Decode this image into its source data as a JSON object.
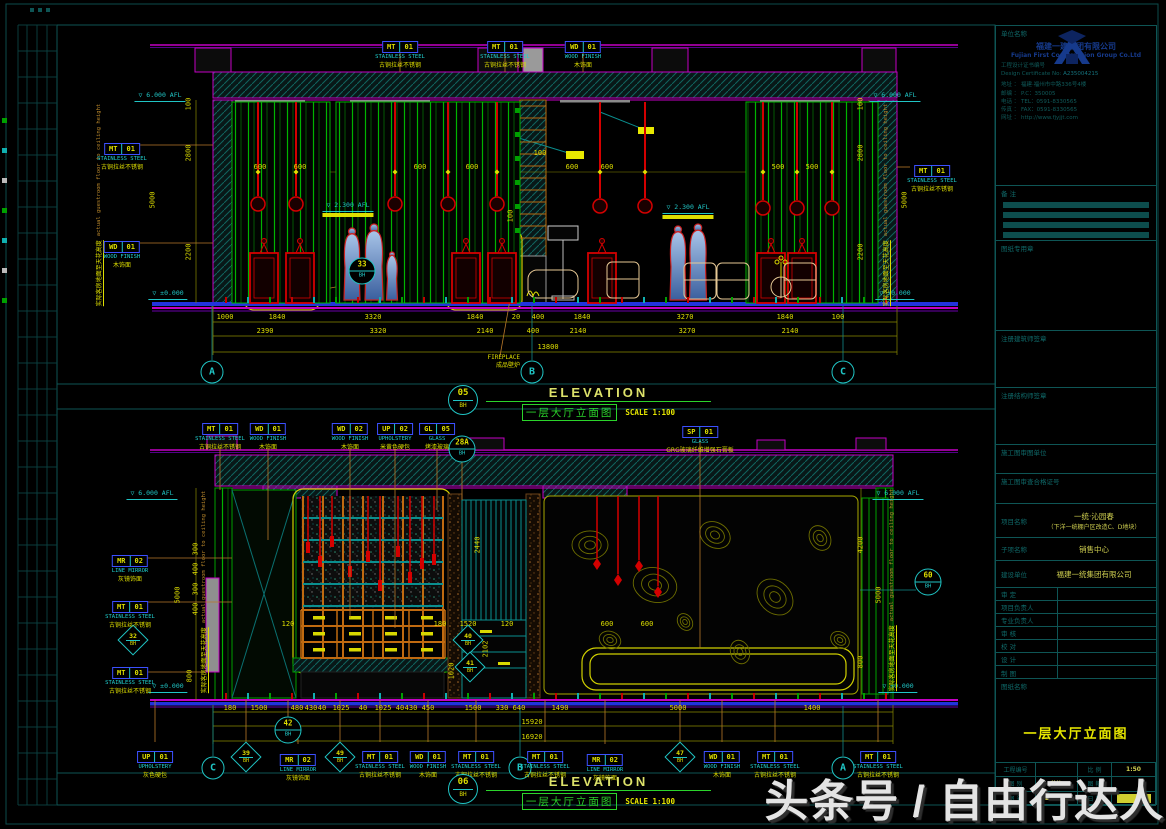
{
  "watermark": "头条号 / 自由行达人",
  "colors": {
    "background": "#000000",
    "frame_teal": "#0e5555",
    "magenta": "#c400c4",
    "green": "#00b400",
    "red": "#d40000",
    "dim_yellow": "#dede00",
    "cyan": "#20c5c5",
    "callout_blue": "#3c50ff",
    "logo_navy": "#163a8c"
  },
  "titles": {
    "upper": {
      "num": "05",
      "sheet": "BH",
      "en": "ELEVATION",
      "cn": "一层大厅立面图",
      "scale": "SCALE 1:100"
    },
    "lower": {
      "num": "06",
      "sheet": "BH",
      "en": "ELEVATION",
      "cn": "一层大厅立面图",
      "scale": "SCALE 1:100"
    }
  },
  "vtext": {
    "cn": "实际客房地面至天花高度",
    "en": "actual guestroom floor to ceiling height"
  },
  "upper": {
    "callouts": [
      {
        "x": 400,
        "y": 34,
        "code": "MT",
        "num": "01",
        "en": "STAINLESS STEEL",
        "cn": "古铜拉丝不锈钢"
      },
      {
        "x": 505,
        "y": 34,
        "code": "MT",
        "num": "01",
        "en": "STAINLESS STEEL",
        "cn": "古铜拉丝不锈钢"
      },
      {
        "x": 583,
        "y": 34,
        "code": "WD",
        "num": "01",
        "en": "WOOD FINISH",
        "cn": "木饰面"
      },
      {
        "x": 122,
        "y": 136,
        "code": "MT",
        "num": "01",
        "en": "STAINLESS STEEL",
        "cn": "古铜拉丝不锈钢"
      },
      {
        "x": 122,
        "y": 234,
        "code": "WD",
        "num": "01",
        "en": "WOOD FINISH",
        "cn": "木饰面"
      },
      {
        "x": 932,
        "y": 158,
        "code": "MT",
        "num": "01",
        "en": "STAINLESS STEEL",
        "cn": "古铜拉丝不锈钢"
      }
    ],
    "dims": [
      {
        "v": "1000",
        "x": 225,
        "y": 314
      },
      {
        "v": "1840",
        "x": 277,
        "y": 314
      },
      {
        "v": "3320",
        "x": 373,
        "y": 314
      },
      {
        "v": "1840",
        "x": 475,
        "y": 314
      },
      {
        "v": "20",
        "x": 516,
        "y": 314
      },
      {
        "v": "400",
        "x": 538,
        "y": 314
      },
      {
        "v": "1840",
        "x": 582,
        "y": 314
      },
      {
        "v": "3270",
        "x": 685,
        "y": 314
      },
      {
        "v": "1840",
        "x": 785,
        "y": 314
      },
      {
        "v": "100",
        "x": 838,
        "y": 314
      },
      {
        "v": "2390",
        "x": 265,
        "y": 328
      },
      {
        "v": "3320",
        "x": 378,
        "y": 328
      },
      {
        "v": "2140",
        "x": 485,
        "y": 328
      },
      {
        "v": "400",
        "x": 533,
        "y": 328
      },
      {
        "v": "2140",
        "x": 578,
        "y": 328
      },
      {
        "v": "3270",
        "x": 687,
        "y": 328
      },
      {
        "v": "2140",
        "x": 790,
        "y": 328
      },
      {
        "v": "13800",
        "x": 548,
        "y": 344
      },
      {
        "v": "600",
        "x": 260,
        "y": 164
      },
      {
        "v": "600",
        "x": 300,
        "y": 164
      },
      {
        "v": "600",
        "x": 420,
        "y": 164
      },
      {
        "v": "600",
        "x": 472,
        "y": 164
      },
      {
        "v": "600",
        "x": 572,
        "y": 164
      },
      {
        "v": "600",
        "x": 607,
        "y": 164
      },
      {
        "v": "500",
        "x": 778,
        "y": 164
      },
      {
        "v": "500",
        "x": 812,
        "y": 164
      },
      {
        "v": "100",
        "x": 540,
        "y": 150
      },
      {
        "v": "100",
        "x": 511,
        "y": 216,
        "r": 1
      },
      {
        "v": "100",
        "x": 189,
        "y": 104,
        "r": 1
      },
      {
        "v": "2800",
        "x": 189,
        "y": 153,
        "r": 1
      },
      {
        "v": "2200",
        "x": 189,
        "y": 252,
        "r": 1
      },
      {
        "v": "5000",
        "x": 153,
        "y": 200,
        "r": 1
      },
      {
        "v": "100",
        "x": 861,
        "y": 104,
        "r": 1
      },
      {
        "v": "2800",
        "x": 861,
        "y": 153,
        "r": 1
      },
      {
        "v": "2200",
        "x": 861,
        "y": 252,
        "r": 1
      },
      {
        "v": "5000",
        "x": 905,
        "y": 200,
        "r": 1
      }
    ],
    "levels": [
      {
        "t": "6.000 AFL",
        "x": 160,
        "y": 92
      },
      {
        "t": "6.000 AFL",
        "x": 895,
        "y": 92
      },
      {
        "t": "±0.000",
        "x": 168,
        "y": 290
      },
      {
        "t": "±0.000",
        "x": 895,
        "y": 290
      },
      {
        "t": "2.300 AFL",
        "x": 348,
        "y": 202,
        "hl": 1
      },
      {
        "t": "2.300 AFL",
        "x": 688,
        "y": 204,
        "hl": 1
      }
    ],
    "bubbles": [
      {
        "t": "A",
        "x": 212,
        "y": 372
      },
      {
        "t": "B",
        "x": 532,
        "y": 372
      },
      {
        "t": "C",
        "x": 843,
        "y": 372
      }
    ],
    "details": [
      {
        "n": "33",
        "s": "BH",
        "x": 362,
        "y": 271
      }
    ],
    "diamonds": [],
    "vtexts": [
      {
        "x": 99,
        "y": 205
      },
      {
        "x": 886,
        "y": 205
      }
    ],
    "fireplace": {
      "en": "FIREPLACE",
      "cn": "成品壁炉",
      "x": 520,
      "y": 354
    }
  },
  "lower": {
    "callouts": [
      {
        "x": 220,
        "y": 416,
        "code": "MT",
        "num": "01",
        "en": "STAINLESS STEEL",
        "cn": "古铜拉丝不锈钢"
      },
      {
        "x": 268,
        "y": 416,
        "code": "WD",
        "num": "01",
        "en": "WOOD FINISH",
        "cn": "木饰面"
      },
      {
        "x": 350,
        "y": 416,
        "code": "WD",
        "num": "02",
        "en": "WOOD FINISH",
        "cn": "木饰面"
      },
      {
        "x": 395,
        "y": 416,
        "code": "UP",
        "num": "02",
        "en": "UPHOLSTERY",
        "cn": "米黄色硬包"
      },
      {
        "x": 437,
        "y": 416,
        "code": "GL",
        "num": "05",
        "en": "GLASS",
        "cn": "烤漆玻璃"
      },
      {
        "x": 700,
        "y": 419,
        "code": "SP",
        "num": "01",
        "en": "GLASS",
        "cn": "GRG玻璃纤维增强石膏板"
      },
      {
        "x": 130,
        "y": 548,
        "code": "MR",
        "num": "02",
        "en": "LINE MIRROR",
        "cn": "灰镜饰面"
      },
      {
        "x": 130,
        "y": 594,
        "code": "MT",
        "num": "01",
        "en": "STAINLESS STEEL",
        "cn": "古铜拉丝不锈钢"
      },
      {
        "x": 130,
        "y": 660,
        "code": "MT",
        "num": "01",
        "en": "STAINLESS STEEL",
        "cn": "古铜拉丝不锈钢"
      },
      {
        "x": 155,
        "y": 744,
        "code": "UP",
        "num": "01",
        "en": "UPHOLSTERY",
        "cn": "灰色硬包"
      },
      {
        "x": 298,
        "y": 747,
        "code": "MR",
        "num": "02",
        "en": "LINE MIRROR",
        "cn": "灰镜饰面"
      },
      {
        "x": 380,
        "y": 744,
        "code": "MT",
        "num": "01",
        "en": "STAINLESS STEEL",
        "cn": "古铜拉丝不锈钢"
      },
      {
        "x": 428,
        "y": 744,
        "code": "WD",
        "num": "01",
        "en": "WOOD FINISH",
        "cn": "木饰面"
      },
      {
        "x": 476,
        "y": 744,
        "code": "MT",
        "num": "01",
        "en": "STAINLESS STEEL",
        "cn": "古铜拉丝不锈钢"
      },
      {
        "x": 545,
        "y": 744,
        "code": "MT",
        "num": "01",
        "en": "STAINLESS STEEL",
        "cn": "古铜拉丝不锈钢"
      },
      {
        "x": 605,
        "y": 747,
        "code": "MR",
        "num": "02",
        "en": "LINE MIRROR",
        "cn": "灰镜饰面"
      },
      {
        "x": 722,
        "y": 744,
        "code": "WD",
        "num": "01",
        "en": "WOOD FINISH",
        "cn": "木饰面"
      },
      {
        "x": 775,
        "y": 744,
        "code": "MT",
        "num": "01",
        "en": "STAINLESS STEEL",
        "cn": "古铜拉丝不锈钢"
      },
      {
        "x": 878,
        "y": 744,
        "code": "MT",
        "num": "01",
        "en": "STAINLESS STEEL",
        "cn": "古铜拉丝不锈钢"
      }
    ],
    "dims": [
      {
        "v": "180",
        "x": 230,
        "y": 705
      },
      {
        "v": "1500",
        "x": 259,
        "y": 705
      },
      {
        "v": "480",
        "x": 297,
        "y": 705
      },
      {
        "v": "430",
        "x": 311,
        "y": 705
      },
      {
        "v": "40",
        "x": 322,
        "y": 705
      },
      {
        "v": "1025",
        "x": 341,
        "y": 705
      },
      {
        "v": "40",
        "x": 363,
        "y": 705
      },
      {
        "v": "1025",
        "x": 383,
        "y": 705
      },
      {
        "v": "40",
        "x": 400,
        "y": 705
      },
      {
        "v": "430",
        "x": 411,
        "y": 705
      },
      {
        "v": "450",
        "x": 428,
        "y": 705
      },
      {
        "v": "1500",
        "x": 473,
        "y": 705
      },
      {
        "v": "330",
        "x": 502,
        "y": 705
      },
      {
        "v": "640",
        "x": 519,
        "y": 705
      },
      {
        "v": "1490",
        "x": 560,
        "y": 705
      },
      {
        "v": "5000",
        "x": 678,
        "y": 705
      },
      {
        "v": "1400",
        "x": 812,
        "y": 705
      },
      {
        "v": "15920",
        "x": 532,
        "y": 719
      },
      {
        "v": "16920",
        "x": 532,
        "y": 734
      },
      {
        "v": "120",
        "x": 288,
        "y": 621
      },
      {
        "v": "180",
        "x": 440,
        "y": 621
      },
      {
        "v": "1520",
        "x": 468,
        "y": 621
      },
      {
        "v": "120",
        "x": 507,
        "y": 621
      },
      {
        "v": "600",
        "x": 607,
        "y": 621
      },
      {
        "v": "600",
        "x": 647,
        "y": 621
      },
      {
        "v": "2440",
        "x": 478,
        "y": 545,
        "r": 1
      },
      {
        "v": "2102",
        "x": 486,
        "y": 649,
        "r": 1
      },
      {
        "v": "1020",
        "x": 452,
        "y": 671,
        "r": 1
      },
      {
        "v": "5000",
        "x": 178,
        "y": 595,
        "r": 1
      },
      {
        "v": "800",
        "x": 190,
        "y": 676,
        "r": 1
      },
      {
        "v": "300",
        "x": 196,
        "y": 549,
        "r": 1
      },
      {
        "v": "400",
        "x": 196,
        "y": 569,
        "r": 1
      },
      {
        "v": "300",
        "x": 196,
        "y": 589,
        "r": 1
      },
      {
        "v": "400",
        "x": 196,
        "y": 609,
        "r": 1
      },
      {
        "v": "4200",
        "x": 861,
        "y": 545,
        "r": 1
      },
      {
        "v": "800",
        "x": 861,
        "y": 662,
        "r": 1
      },
      {
        "v": "5000",
        "x": 879,
        "y": 595,
        "r": 1
      }
    ],
    "levels": [
      {
        "t": "6.000 AFL",
        "x": 152,
        "y": 490
      },
      {
        "t": "6.000 AFL",
        "x": 898,
        "y": 490
      },
      {
        "t": "±0.000",
        "x": 168,
        "y": 683
      },
      {
        "t": "±0.000",
        "x": 898,
        "y": 683
      }
    ],
    "bubbles": [
      {
        "t": "C",
        "x": 213,
        "y": 768
      },
      {
        "t": "B",
        "x": 520,
        "y": 768
      },
      {
        "t": "A",
        "x": 843,
        "y": 768
      }
    ],
    "details": [
      {
        "n": "42",
        "s": "BH",
        "x": 288,
        "y": 730
      },
      {
        "n": "28A",
        "s": "BH",
        "x": 462,
        "y": 449
      },
      {
        "n": "60",
        "s": "BH",
        "x": 928,
        "y": 582
      }
    ],
    "diamonds": [
      {
        "n": "32",
        "s": "BH",
        "x": 133,
        "y": 640
      },
      {
        "n": "39",
        "s": "BH",
        "x": 246,
        "y": 757
      },
      {
        "n": "49",
        "s": "BH",
        "x": 340,
        "y": 757
      },
      {
        "n": "47",
        "s": "BH",
        "x": 680,
        "y": 757
      },
      {
        "n": "40",
        "s": "BH",
        "x": 468,
        "y": 640
      },
      {
        "n": "41",
        "s": "BH",
        "x": 470,
        "y": 667
      }
    ],
    "vtexts": [
      {
        "x": 204,
        "y": 592
      },
      {
        "x": 892,
        "y": 590
      }
    ]
  },
  "title_block": {
    "section_labels": {
      "company": "单位名称",
      "notes": "备  注",
      "seal": "图纸专用章",
      "arch_seal": "注册建筑师签章",
      "struct_seal": "注册结构师签章",
      "review_unit": "施工图审图单位",
      "review_cert": "施工图审查合格证号",
      "project": "项目名称",
      "subproject": "子项名称",
      "client": "建设单位",
      "drawing_name": "图纸名称",
      "project_no": "工程编号",
      "scale": "比 例",
      "category": "图 别",
      "sheet_size": "图 幅",
      "sheet_no": "图 号",
      "date": "日 期"
    },
    "company_cn": "福建一建集团有限公司",
    "company_en": "Fujian First Construction Group Co.Ltd",
    "cert_label": "工程设计证书编号",
    "cert_en": "Design Certificate No:",
    "cert_no": "A235004215",
    "contact": [
      {
        "label": "地址",
        "value": "福建·福州市中路336号4楼"
      },
      {
        "label": "邮编",
        "value": "P.C：350005"
      },
      {
        "label": "电话",
        "value": "TEL：0591-8330565"
      },
      {
        "label": "传真",
        "value": "FAX：0591-8330565"
      },
      {
        "label": "网址",
        "value": "http://www.fjyjjt.com"
      }
    ],
    "project_name_1": "一统·沁园春",
    "project_name_2": "（下洋一统棚户区改造C、D地块）",
    "subproject_value": "销售中心",
    "client_value": "福建一统集团有限公司",
    "sign_rows": [
      "审 定",
      "项目负责人",
      "专业负责人",
      "审 核",
      "校 对",
      "设 计",
      "制 图"
    ],
    "drawing_title": "一层大厅立面图",
    "scale_value": "1:50",
    "category_value": "装饰",
    "sheet_no_value": "LD—03"
  }
}
